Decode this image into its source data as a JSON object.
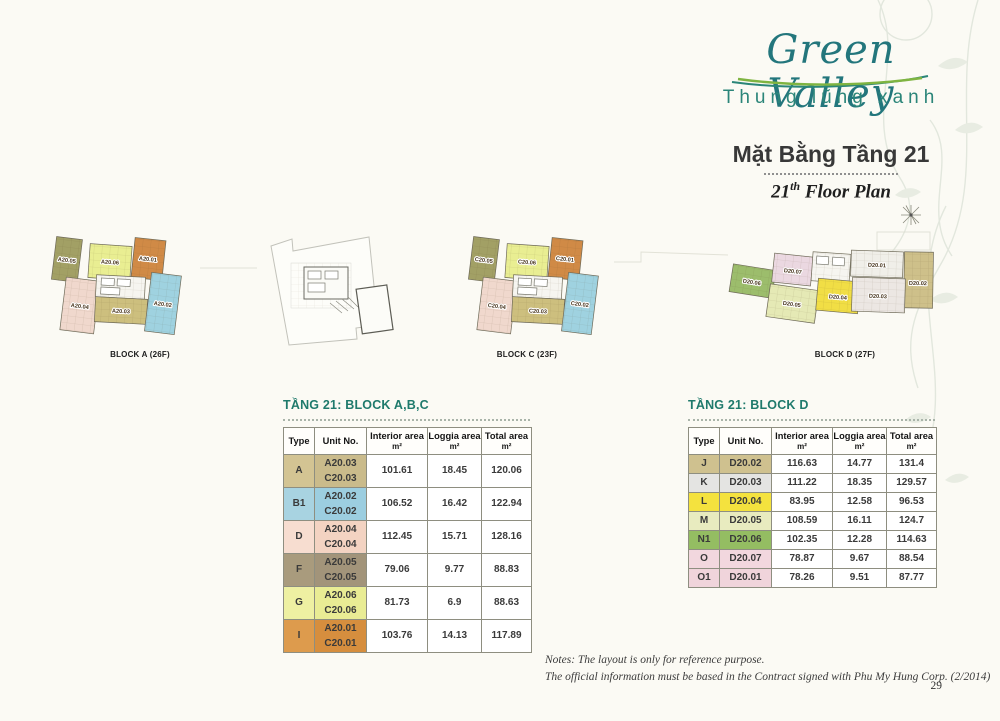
{
  "header": {
    "logo_title": "Green Valley",
    "logo_subtitle": "Thung lũng xanh",
    "title_vi": "Mặt Bằng Tầng 21",
    "floor_num": "21",
    "floor_sup": "th",
    "floor_rest": " Floor Plan"
  },
  "colors": {
    "accent_teal": "#1f7a6c",
    "logo_teal": "#23767c",
    "swoosh_green": "#7fb441",
    "swoosh_teal": "#2a8578",
    "plan": {
      "tan": "#cdbf7e",
      "blue": "#9fd2e0",
      "pink": "#f0d8cd",
      "olive": "#a2a065",
      "yellow": "#e9ee92",
      "orange": "#d08a46",
      "core": "#f6f5f0",
      "d_green": "#9cbd6c",
      "d_pink": "#ebd8e1",
      "d_pale": "#e5e9b5",
      "d_yellow": "#f1de45",
      "d_white": "#f0efe9",
      "d_white2": "#ece7e3",
      "d_tan": "#cec08a"
    }
  },
  "plans": {
    "block_a": {
      "caption": "BLOCK A (26F)",
      "u01": "A20.01",
      "u02": "A20.02",
      "u03": "A20.03",
      "u04": "A20.04",
      "u05": "A20.05",
      "u06": "A20.06"
    },
    "block_c": {
      "caption": "BLOCK C (23F)",
      "u01": "C20.01",
      "u02": "C20.02",
      "u03": "C20.03",
      "u04": "C20.04",
      "u05": "C20.05",
      "u06": "C20.06"
    },
    "block_d": {
      "caption": "BLOCK D (27F)",
      "u01": "D20.01",
      "u02": "D20.02",
      "u03": "D20.03",
      "u04": "D20.04",
      "u05": "D20.05",
      "u06": "D20.06",
      "u07": "D20.07"
    }
  },
  "tables": {
    "abc": {
      "title": "TẦNG 21: BLOCK A,B,C",
      "headers": [
        {
          "label": "Type"
        },
        {
          "label": "Unit No."
        },
        {
          "label": "Interior area",
          "sub": "m²"
        },
        {
          "label": "Loggia area",
          "sub": "m²"
        },
        {
          "label": "Total area",
          "sub": "m²"
        }
      ],
      "rows": [
        {
          "type": "A",
          "color": "#d3c493",
          "color2": "#cabb8b",
          "units": [
            "A20.03",
            "C20.03"
          ],
          "interior": "101.61",
          "loggia": "18.45",
          "total": "120.06"
        },
        {
          "type": "B1",
          "color": "#a8d3e1",
          "color2": "#9ccee0",
          "units": [
            "A20.02",
            "C20.02"
          ],
          "interior": "106.52",
          "loggia": "16.42",
          "total": "122.94"
        },
        {
          "type": "D",
          "color": "#f7ddd0",
          "color2": "#f3d3c2",
          "units": [
            "A20.04",
            "C20.04"
          ],
          "interior": "112.45",
          "loggia": "15.71",
          "total": "128.16"
        },
        {
          "type": "F",
          "color": "#a99b7d",
          "color2": "#a2947a",
          "units": [
            "A20.05",
            "C20.05"
          ],
          "interior": "79.06",
          "loggia": "9.77",
          "total": "88.83"
        },
        {
          "type": "G",
          "color": "#eef0a2",
          "color2": "#e9ec94",
          "units": [
            "A20.06",
            "C20.06"
          ],
          "interior": "81.73",
          "loggia": "6.9",
          "total": "88.63"
        },
        {
          "type": "I",
          "color": "#dd9b4d",
          "color2": "#d68e3e",
          "units": [
            "A20.01",
            "C20.01"
          ],
          "interior": "103.76",
          "loggia": "14.13",
          "total": "117.89"
        }
      ]
    },
    "d": {
      "title": "TẦNG 21: BLOCK D",
      "headers": [
        {
          "label": "Type"
        },
        {
          "label": "Unit No."
        },
        {
          "label": "Interior area",
          "sub": "m²"
        },
        {
          "label": "Loggia area",
          "sub": "m²"
        },
        {
          "label": "Total area",
          "sub": "m²"
        }
      ],
      "rows": [
        {
          "type": "J",
          "color": "#cfc18f",
          "unit": "D20.02",
          "interior": "116.63",
          "loggia": "14.77",
          "total": "131.4"
        },
        {
          "type": "K",
          "color": "#e4e4e2",
          "unit": "D20.03",
          "interior": "111.22",
          "loggia": "18.35",
          "total": "129.57"
        },
        {
          "type": "L",
          "color": "#f4e23e",
          "unit": "D20.04",
          "interior": "83.95",
          "loggia": "12.58",
          "total": "96.53"
        },
        {
          "type": "M",
          "color": "#e8ebbf",
          "unit": "D20.05",
          "interior": "108.59",
          "loggia": "16.11",
          "total": "124.7"
        },
        {
          "type": "N1",
          "color": "#94bd62",
          "unit": "D20.06",
          "interior": "102.35",
          "loggia": "12.28",
          "total": "114.63"
        },
        {
          "type": "O",
          "color": "#f2d7de",
          "unit": "D20.07",
          "interior": "78.87",
          "loggia": "9.67",
          "total": "88.54"
        },
        {
          "type": "O1",
          "color": "#f0d4db",
          "unit": "D20.01",
          "interior": "78.26",
          "loggia": "9.51",
          "total": "87.77"
        }
      ]
    }
  },
  "footer": {
    "notes_line1": "Notes: The layout is only for reference purpose.",
    "notes_line2": "The official information must be based in the Contract signed with Phu My Hung Corp. (2/2014)",
    "page_number": "29"
  }
}
